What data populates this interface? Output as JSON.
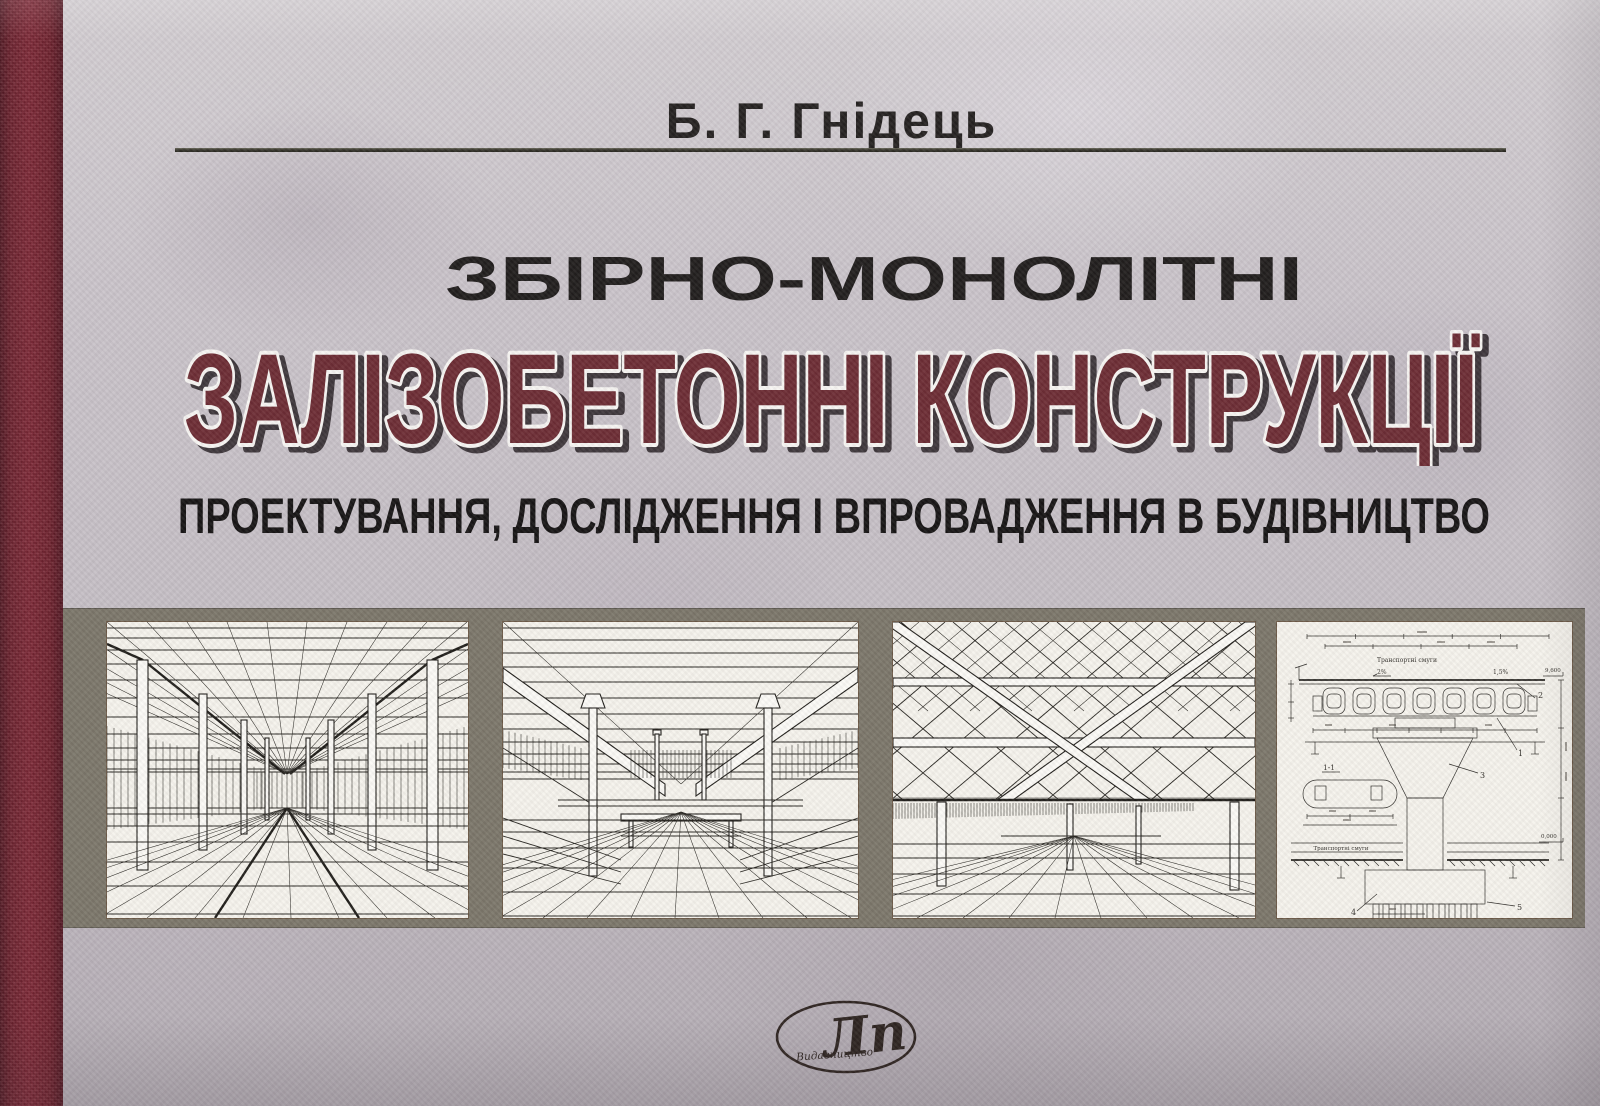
{
  "book_cover": {
    "author": "Б. Г. Гнідець",
    "title_line1": "ЗБІРНО-МОНОЛІТНІ",
    "title_main": "ЗАЛІЗОБЕТОННІ КОНСТРУКЦІЇ",
    "subtitle": "ПРОЕКТУВАННЯ, ДОСЛІДЖЕННЯ І ВПРОВАДЖЕННЯ В БУДІВНИЦТВО",
    "publisher_logo": {
      "monogram": "Лп",
      "caption": "Видавництво"
    },
    "colors": {
      "spine_red": "#6e202c",
      "title_maroon": "#6b2a32",
      "cover_gray": "#c5bfc5",
      "band_olive": "#7a7568",
      "panel_paper": "#f5f3ec"
    },
    "panels": [
      {
        "name": "ribbed-roof-hall-perspective-drawing"
      },
      {
        "name": "flat-slab-frame-interior-perspective-drawing"
      },
      {
        "name": "space-lattice-roof-perspective-drawing"
      },
      {
        "name": "bridge-pier-cross-section-drawing",
        "labels": {
          "lane_top": "Транспортні смуги",
          "lane_bottom": "Транспортні смуги",
          "slope_left": "2%",
          "slope_right": "1,5%",
          "elevation_top": "9,600",
          "elevation_bottom": "0,000",
          "section": "1-1",
          "part_1": "1",
          "part_2": "2",
          "part_3": "3",
          "part_4": "4",
          "part_5": "5"
        }
      }
    ]
  }
}
